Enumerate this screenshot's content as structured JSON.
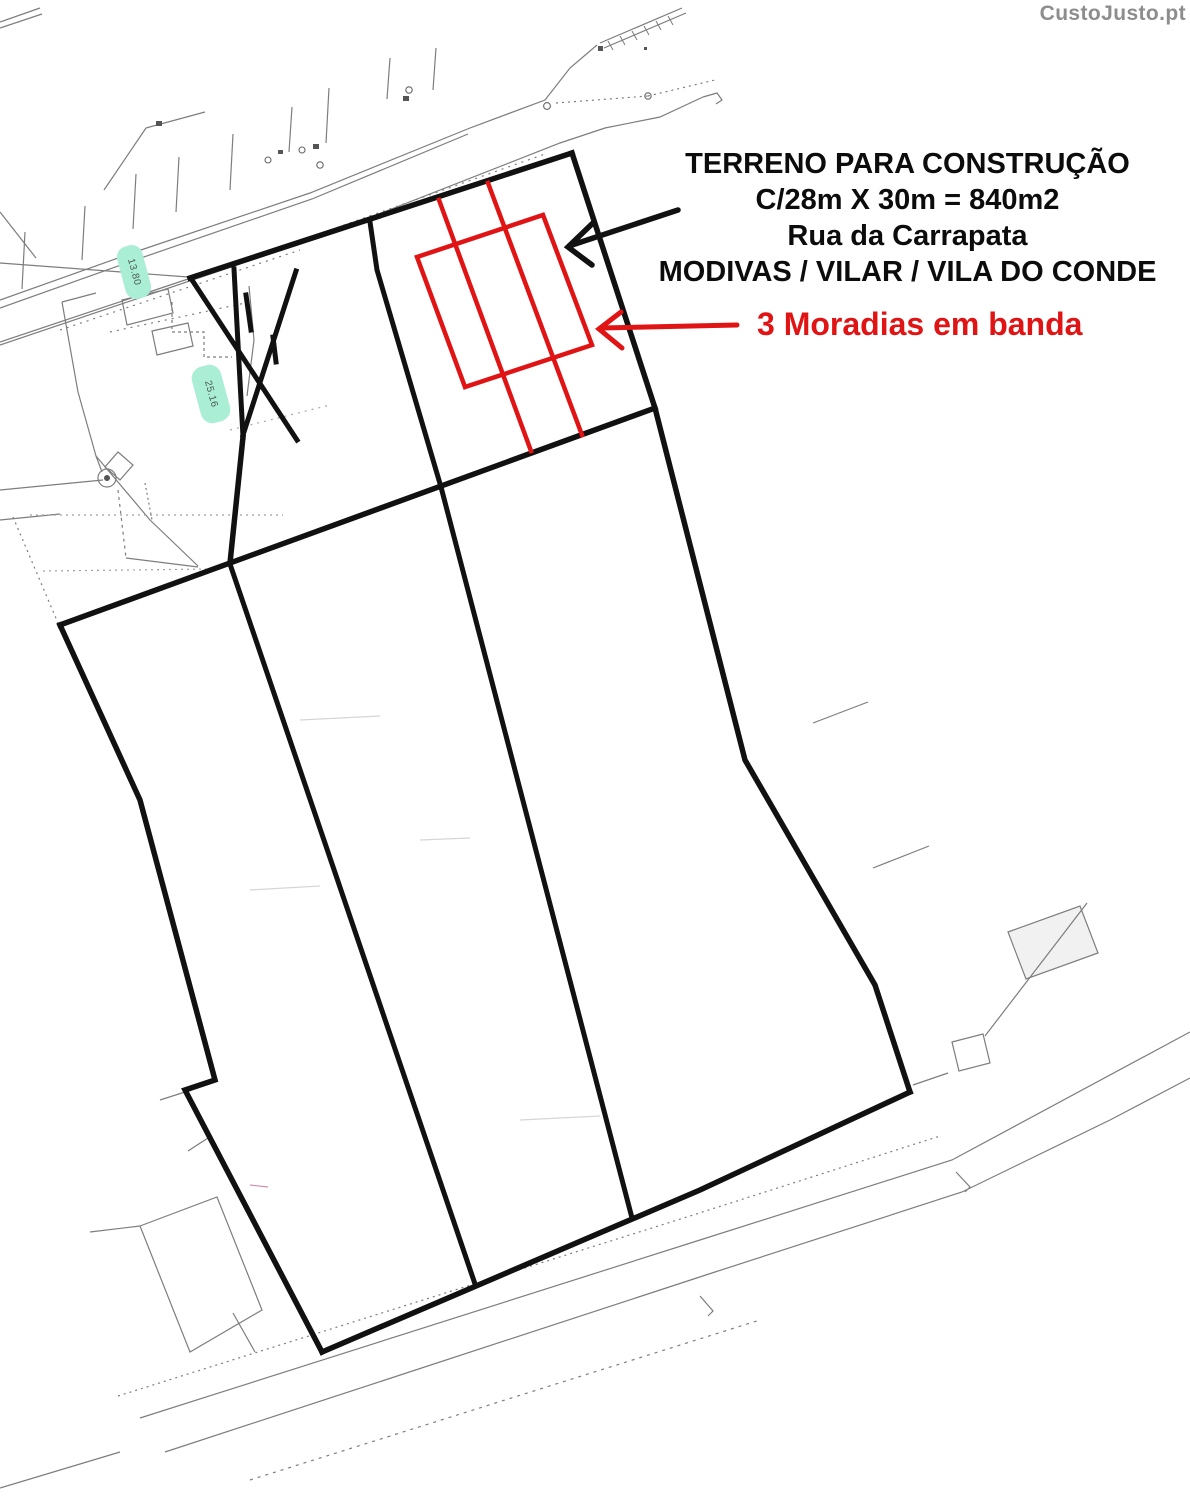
{
  "watermark": {
    "label": "CustoJusto.pt"
  },
  "annotation": {
    "line1": "TERRENO PARA CONSTRUÇÃO",
    "line2": "C/28m X 30m = 840m2",
    "line3": "Rua da Carrapata",
    "line4": "MODIVAS / VILAR / VILA DO CONDE"
  },
  "red_note": {
    "label": "3 Moradias em banda"
  },
  "plan": {
    "type": "scanned cadastral site plan",
    "plot": {
      "frontage_m": 28,
      "depth_m": 30,
      "area_m2": 840,
      "houses_marked": 3
    },
    "measurement_labels": [
      {
        "value": "13.80"
      },
      {
        "value": "25.16"
      }
    ],
    "colors": {
      "outline_black": "#111111",
      "overlay_red": "#e01414",
      "survey_gray": "#7d7d7d",
      "highlight_cyan": "#abeed6",
      "watermark_gray": "#8d8d8d"
    }
  }
}
